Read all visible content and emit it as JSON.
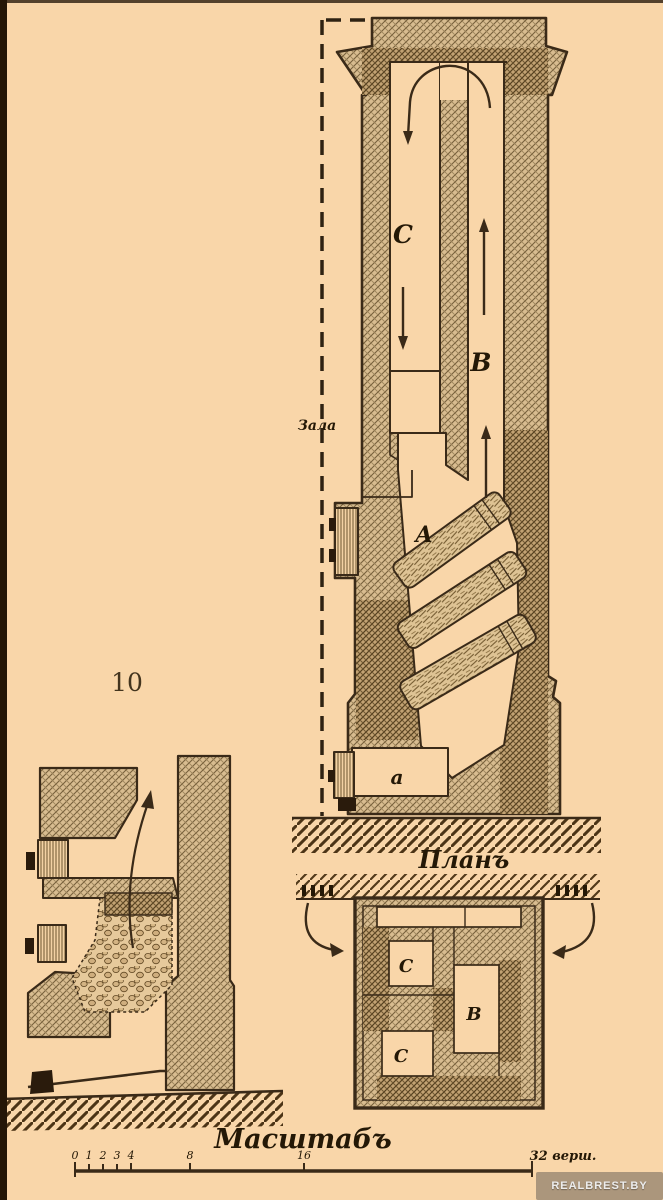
{
  "page": {
    "figure_number": "10",
    "watermark": "REALBREST.BY"
  },
  "elevation": {
    "room_label": "Зала",
    "labels": {
      "down_channel": "C",
      "up_channel": "B",
      "firebox": "A",
      "ash_pit": "a"
    }
  },
  "plan": {
    "title": "Планъ",
    "labels": {
      "channel_top": "C",
      "flue_center": "B",
      "channel_bottom": "C"
    }
  },
  "scale": {
    "title": "Масштабъ",
    "ticks": [
      "0",
      "1",
      "2",
      "3",
      "4",
      "8",
      "16"
    ],
    "end_label": "32 верш."
  },
  "colors": {
    "background": "#f9d6a9",
    "ink": "#3a2a18",
    "masonry": "#d8bc90",
    "masonry_dark": "#c2a273"
  }
}
